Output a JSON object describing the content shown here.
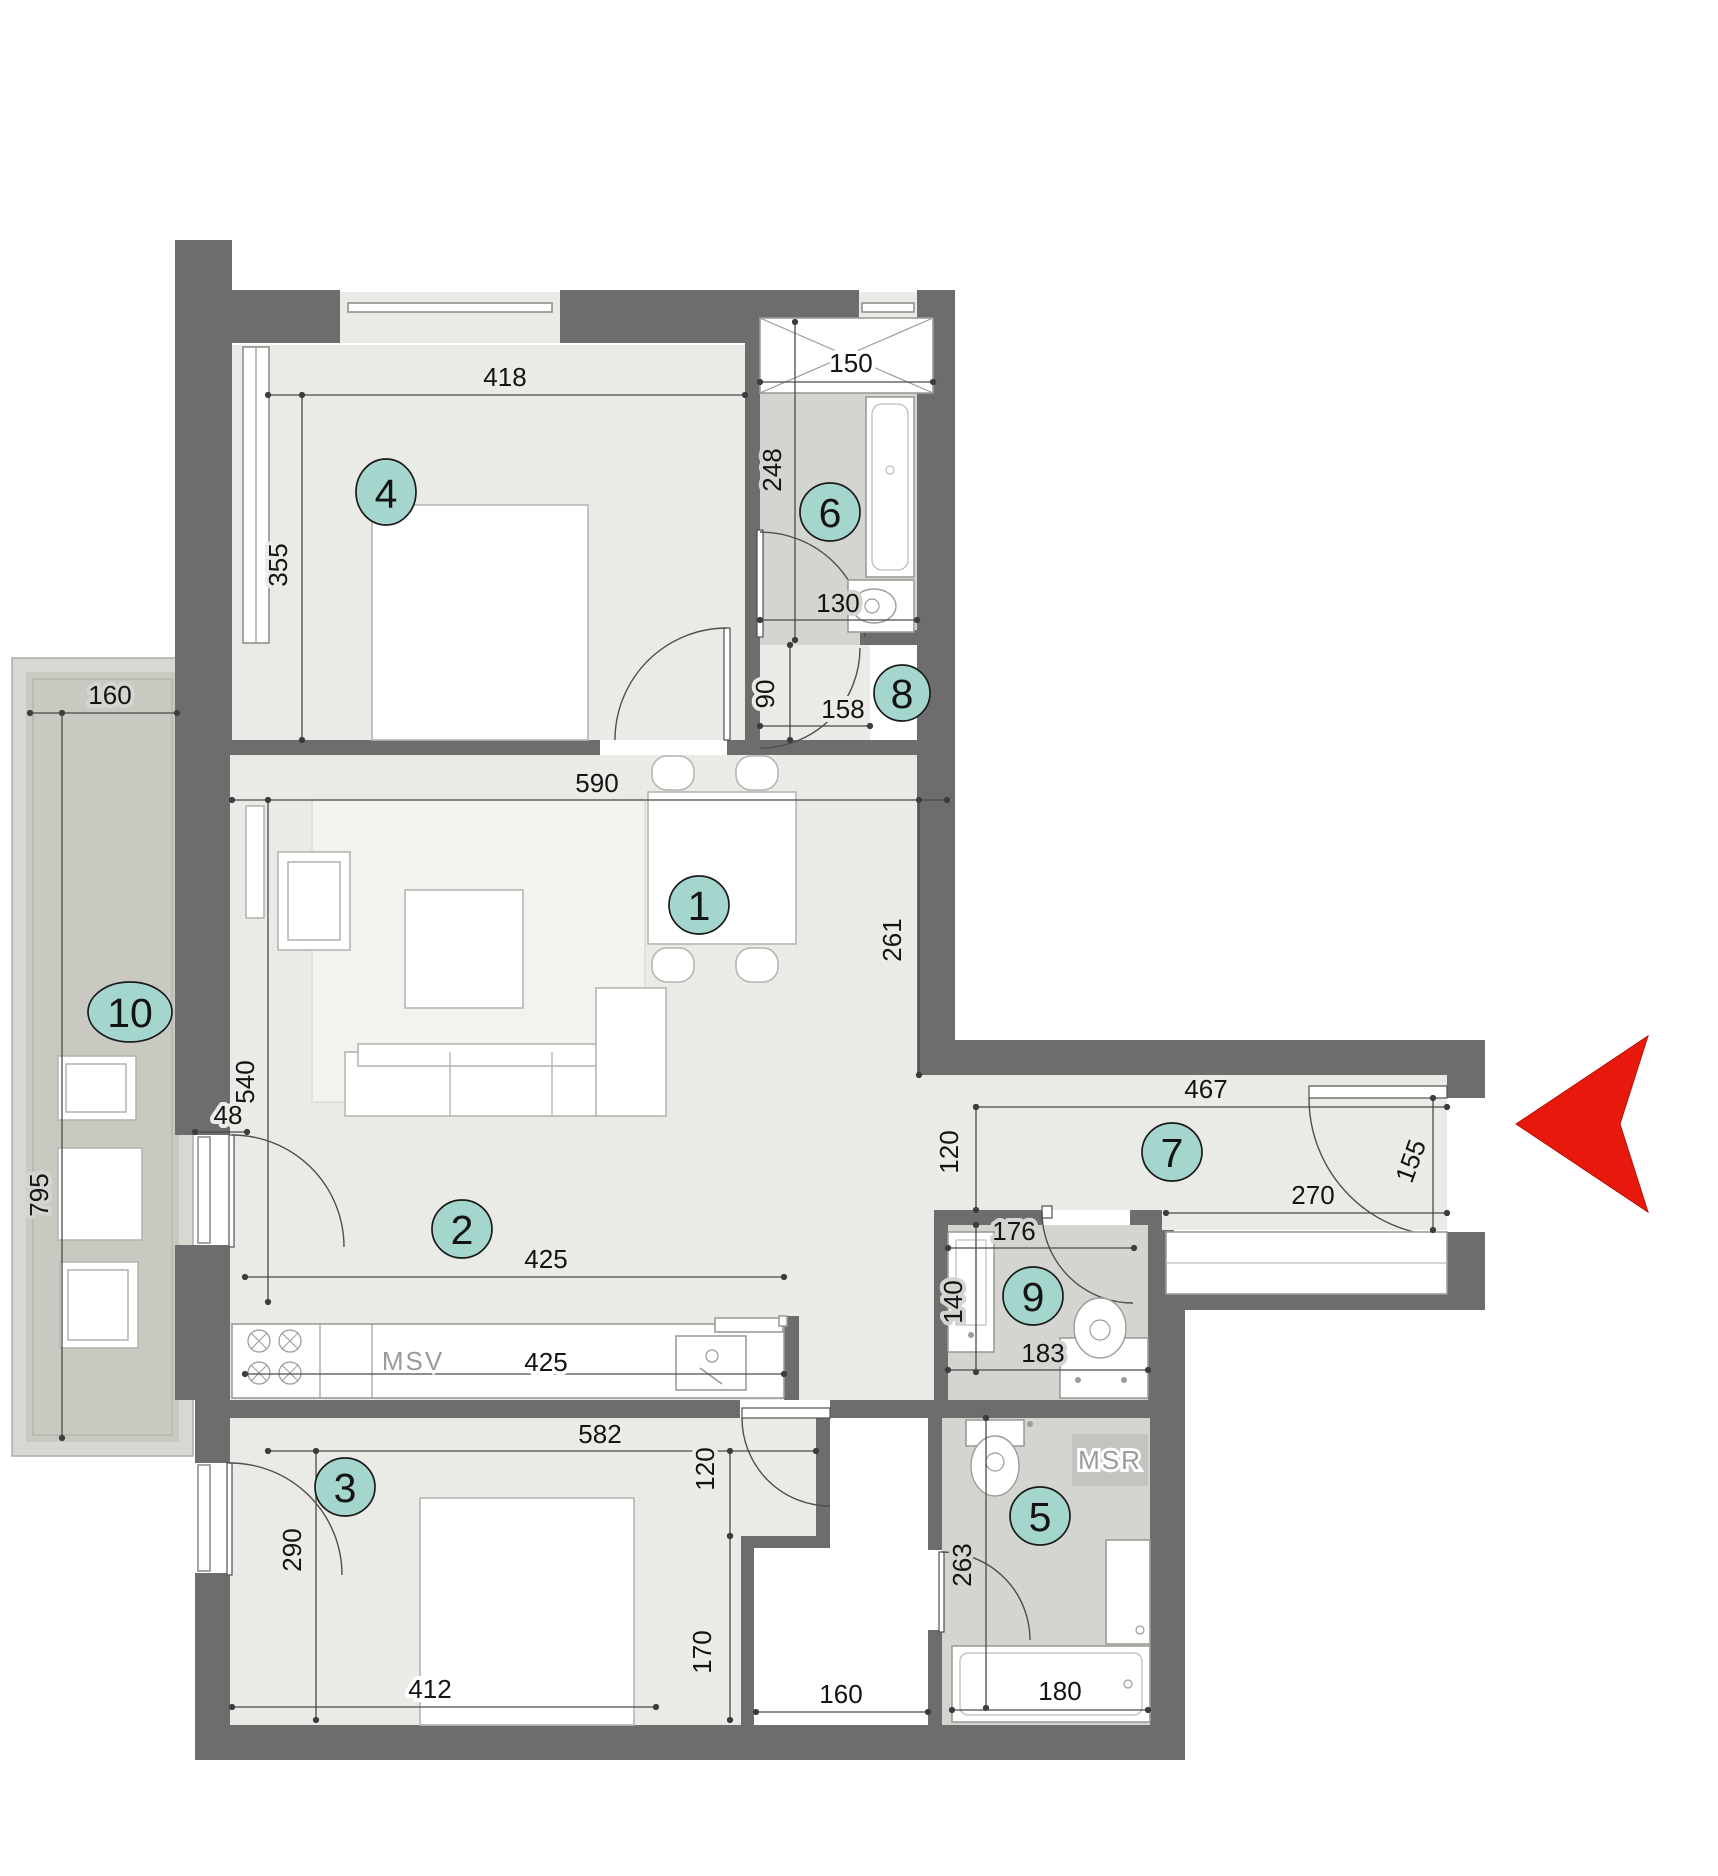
{
  "title": "apartment-floor-plan",
  "rooms": {
    "living_dining": "1",
    "kitchen": "2",
    "bedroom_lower": "3",
    "bedroom_upper": "4",
    "bathroom_lower": "5",
    "bathroom_upper": "6",
    "hallway": "7",
    "storage": "8",
    "wc": "9",
    "balcony": "10"
  },
  "dims": {
    "room4_width": "418",
    "room4_depth": "355",
    "wardrobe6_width": "150",
    "bath6_depth": "248",
    "bath6_width": "130",
    "corridor_width": "90",
    "corridor_length": "158",
    "living_width": "590",
    "dining_depth": "261",
    "balcony_door": "48",
    "living_depth": "540",
    "kitchen_clear": "425",
    "kitchen_counter": "425",
    "hall_length": "467",
    "hall_width": "120",
    "entry_width": "155",
    "hall_closet": "270",
    "wc_width": "176",
    "wc_depth": "140",
    "wc_bottom": "183",
    "room3_width": "582",
    "room3_nook_width": "120",
    "room3_nook_depth": "170",
    "room3_door_side": "290",
    "room3_bed": "412",
    "niche_width": "160",
    "bath5_depth": "263",
    "bath5_width": "180",
    "balcony_width": "160",
    "balcony_length": "795"
  },
  "labels": {
    "msv": "MSV",
    "msr": "MSR"
  },
  "colors": {
    "wall": "#6d6d6d",
    "floor": "#eaeae6",
    "floor_bath": "#d4d4d1",
    "floor_balcony": "#c9c9c2",
    "parapet": "#d8d8d2",
    "fixture": "#9c9c97",
    "furniture": "#b6b6b1",
    "dimline": "#4a4a4a",
    "glazing": "#8f8f8a",
    "door": "#4f4f4f",
    "badge": "#a5d6ce",
    "badge_border": "#1b1b1b",
    "arrow": "#e8190c",
    "label_muted": "#9a9a98"
  }
}
